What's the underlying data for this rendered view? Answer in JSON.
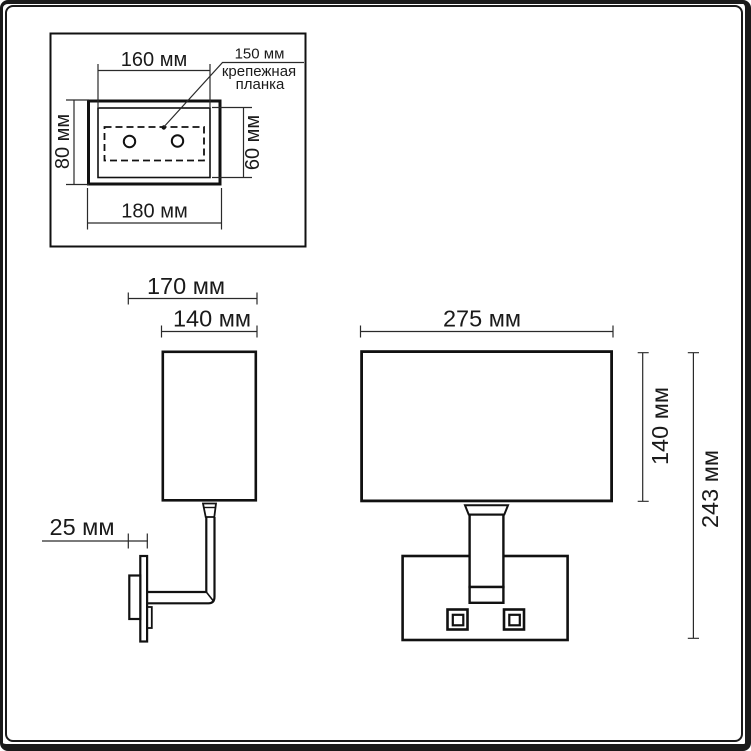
{
  "drawing": {
    "units": "мм",
    "colors": {
      "line": "#1a1a1a",
      "background": "#ffffff"
    },
    "inset": {
      "dim_160": "160 мм",
      "dim_150": "150 мм",
      "note_line1": "крепежная",
      "note_line2": "планка",
      "dim_80": "80 мм",
      "dim_60": "60 мм",
      "dim_180": "180 мм"
    },
    "side_view": {
      "dim_170": "170 мм",
      "dim_140": "140 мм",
      "dim_25": "25 мм"
    },
    "front_view": {
      "dim_275": "275 мм",
      "dim_140": "140 мм",
      "dim_243": "243 мм"
    }
  }
}
